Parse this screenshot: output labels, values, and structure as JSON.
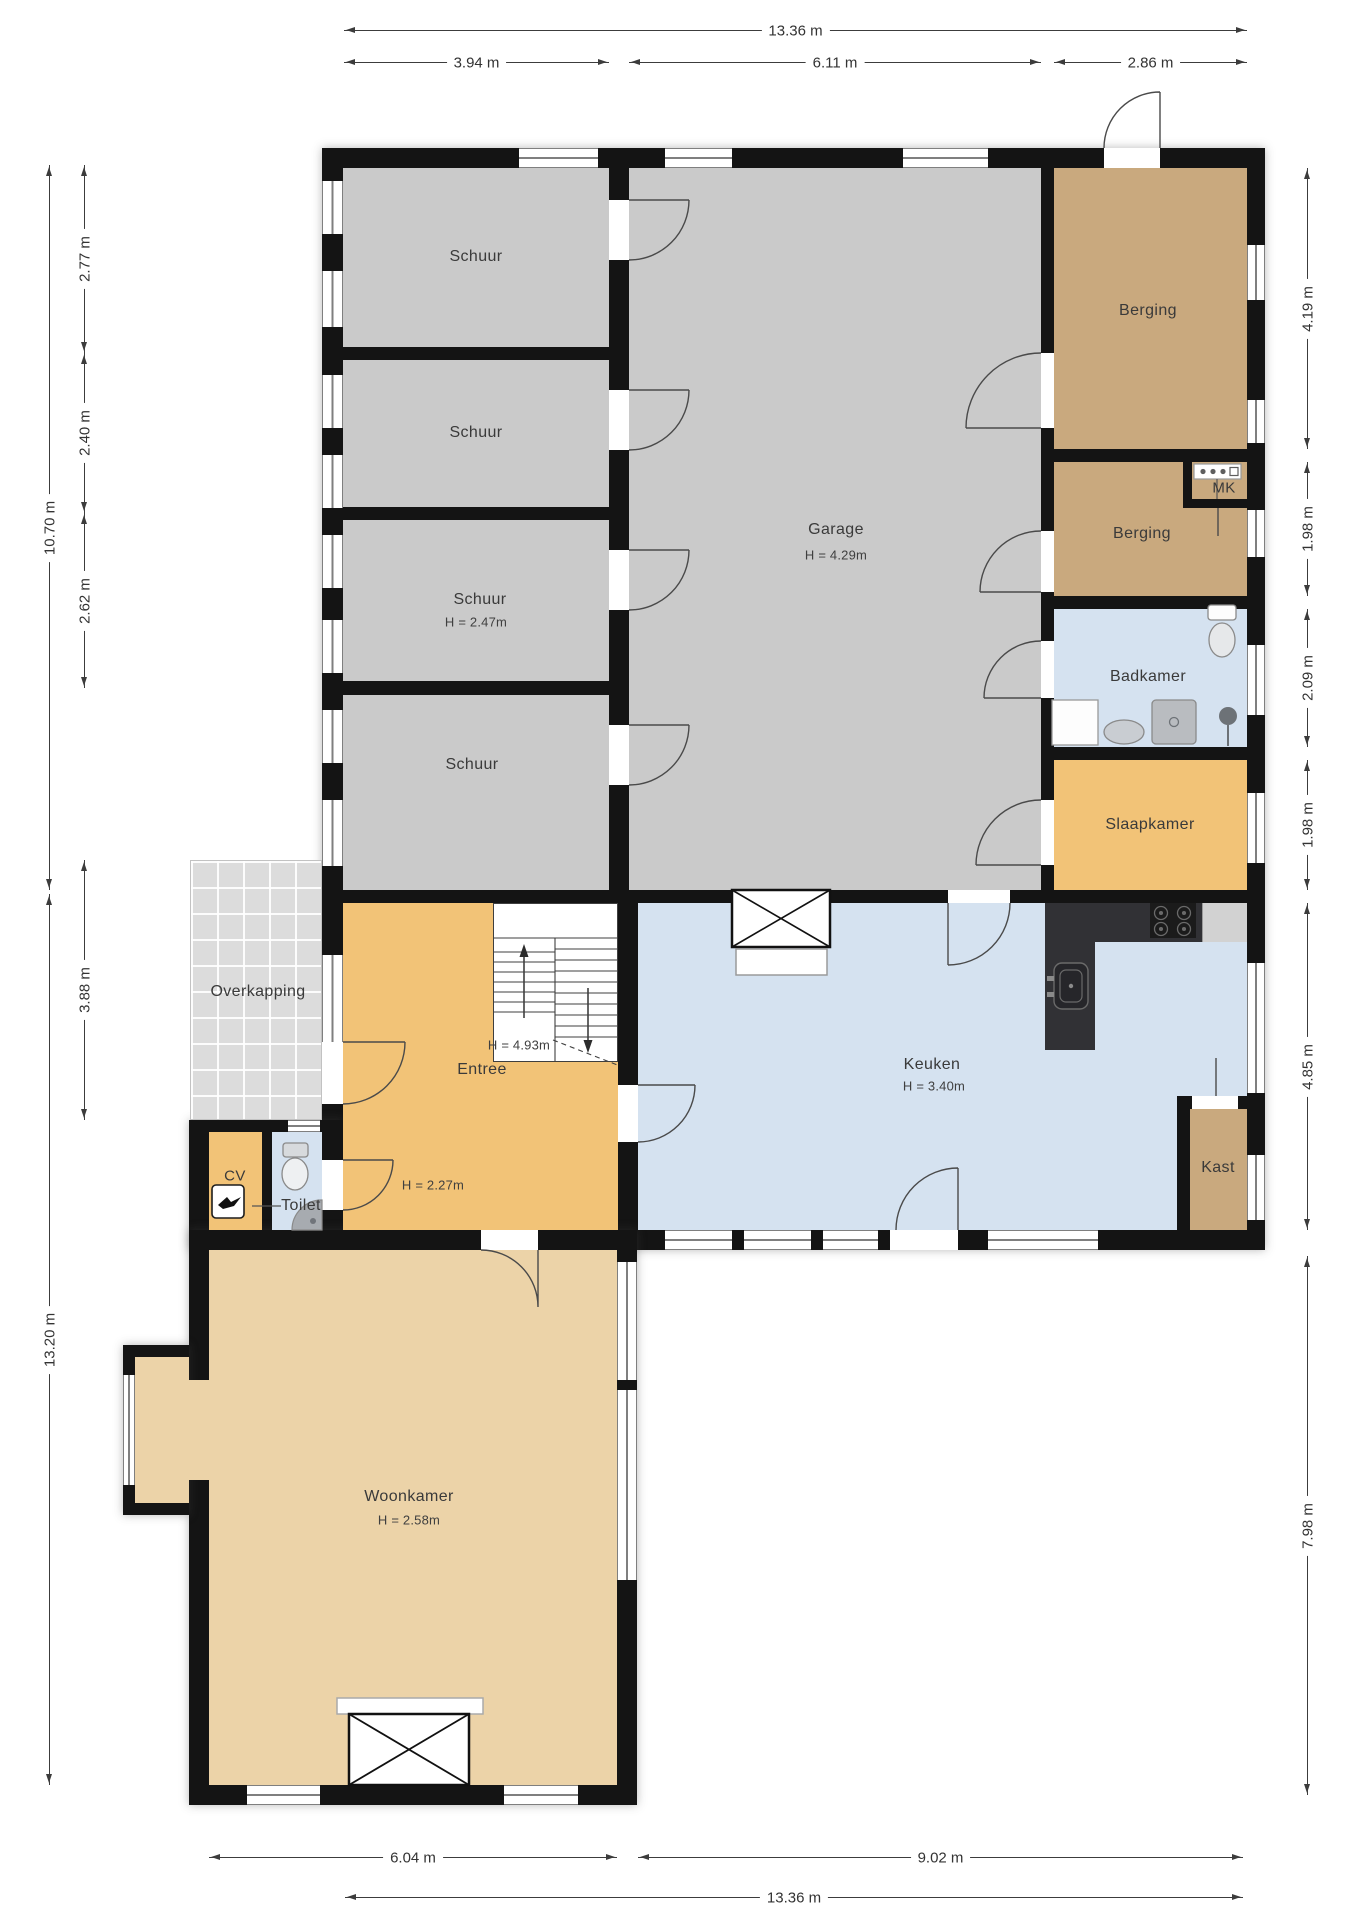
{
  "plan": {
    "title": "Begane grond plattegrond",
    "rooms": [
      {
        "id": "schuur-1",
        "label": "Schuur"
      },
      {
        "id": "schuur-2",
        "label": "Schuur"
      },
      {
        "id": "schuur-3",
        "label": "Schuur",
        "height": "H = 2.47m"
      },
      {
        "id": "schuur-4",
        "label": "Schuur"
      },
      {
        "id": "garage",
        "label": "Garage",
        "height": "H = 4.29m"
      },
      {
        "id": "berging-1",
        "label": "Berging"
      },
      {
        "id": "mk",
        "label": "MK"
      },
      {
        "id": "berging-2",
        "label": "Berging"
      },
      {
        "id": "badkamer",
        "label": "Badkamer"
      },
      {
        "id": "slaapkamer",
        "label": "Slaapkamer"
      },
      {
        "id": "keuken",
        "label": "Keuken",
        "height": "H = 3.40m"
      },
      {
        "id": "entree",
        "label": "Entree",
        "stair_height": "H = 4.93m",
        "height": "H = 2.27m"
      },
      {
        "id": "overkapping",
        "label": "Overkapping"
      },
      {
        "id": "cv",
        "label": "CV"
      },
      {
        "id": "toilet",
        "label": "Toilet"
      },
      {
        "id": "kast",
        "label": "Kast"
      },
      {
        "id": "woonkamer",
        "label": "Woonkamer",
        "height": "H = 2.58m"
      }
    ],
    "dimensions": {
      "top_total": "13.36 m",
      "top_segments": [
        "3.94 m",
        "6.11 m",
        "2.86 m"
      ],
      "left_outer": [
        "10.70 m",
        "13.20 m"
      ],
      "left_inner": [
        "2.77 m",
        "2.40 m",
        "2.62 m",
        "3.88 m"
      ],
      "right": [
        "4.19 m",
        "1.98 m",
        "2.09 m",
        "1.98 m",
        "4.85 m",
        "7.98 m"
      ],
      "bottom": [
        "6.04 m",
        "9.02 m"
      ],
      "bottom_total": "13.36 m"
    },
    "colors": {
      "wall": "#141414",
      "shed": "#cacaca",
      "storage": "#c9a97e",
      "bath": "#d5e2f0",
      "bed": "#f2c377",
      "living": "#ecd3a8",
      "canopy": "#dcdcdc",
      "counter": "#313135"
    }
  }
}
